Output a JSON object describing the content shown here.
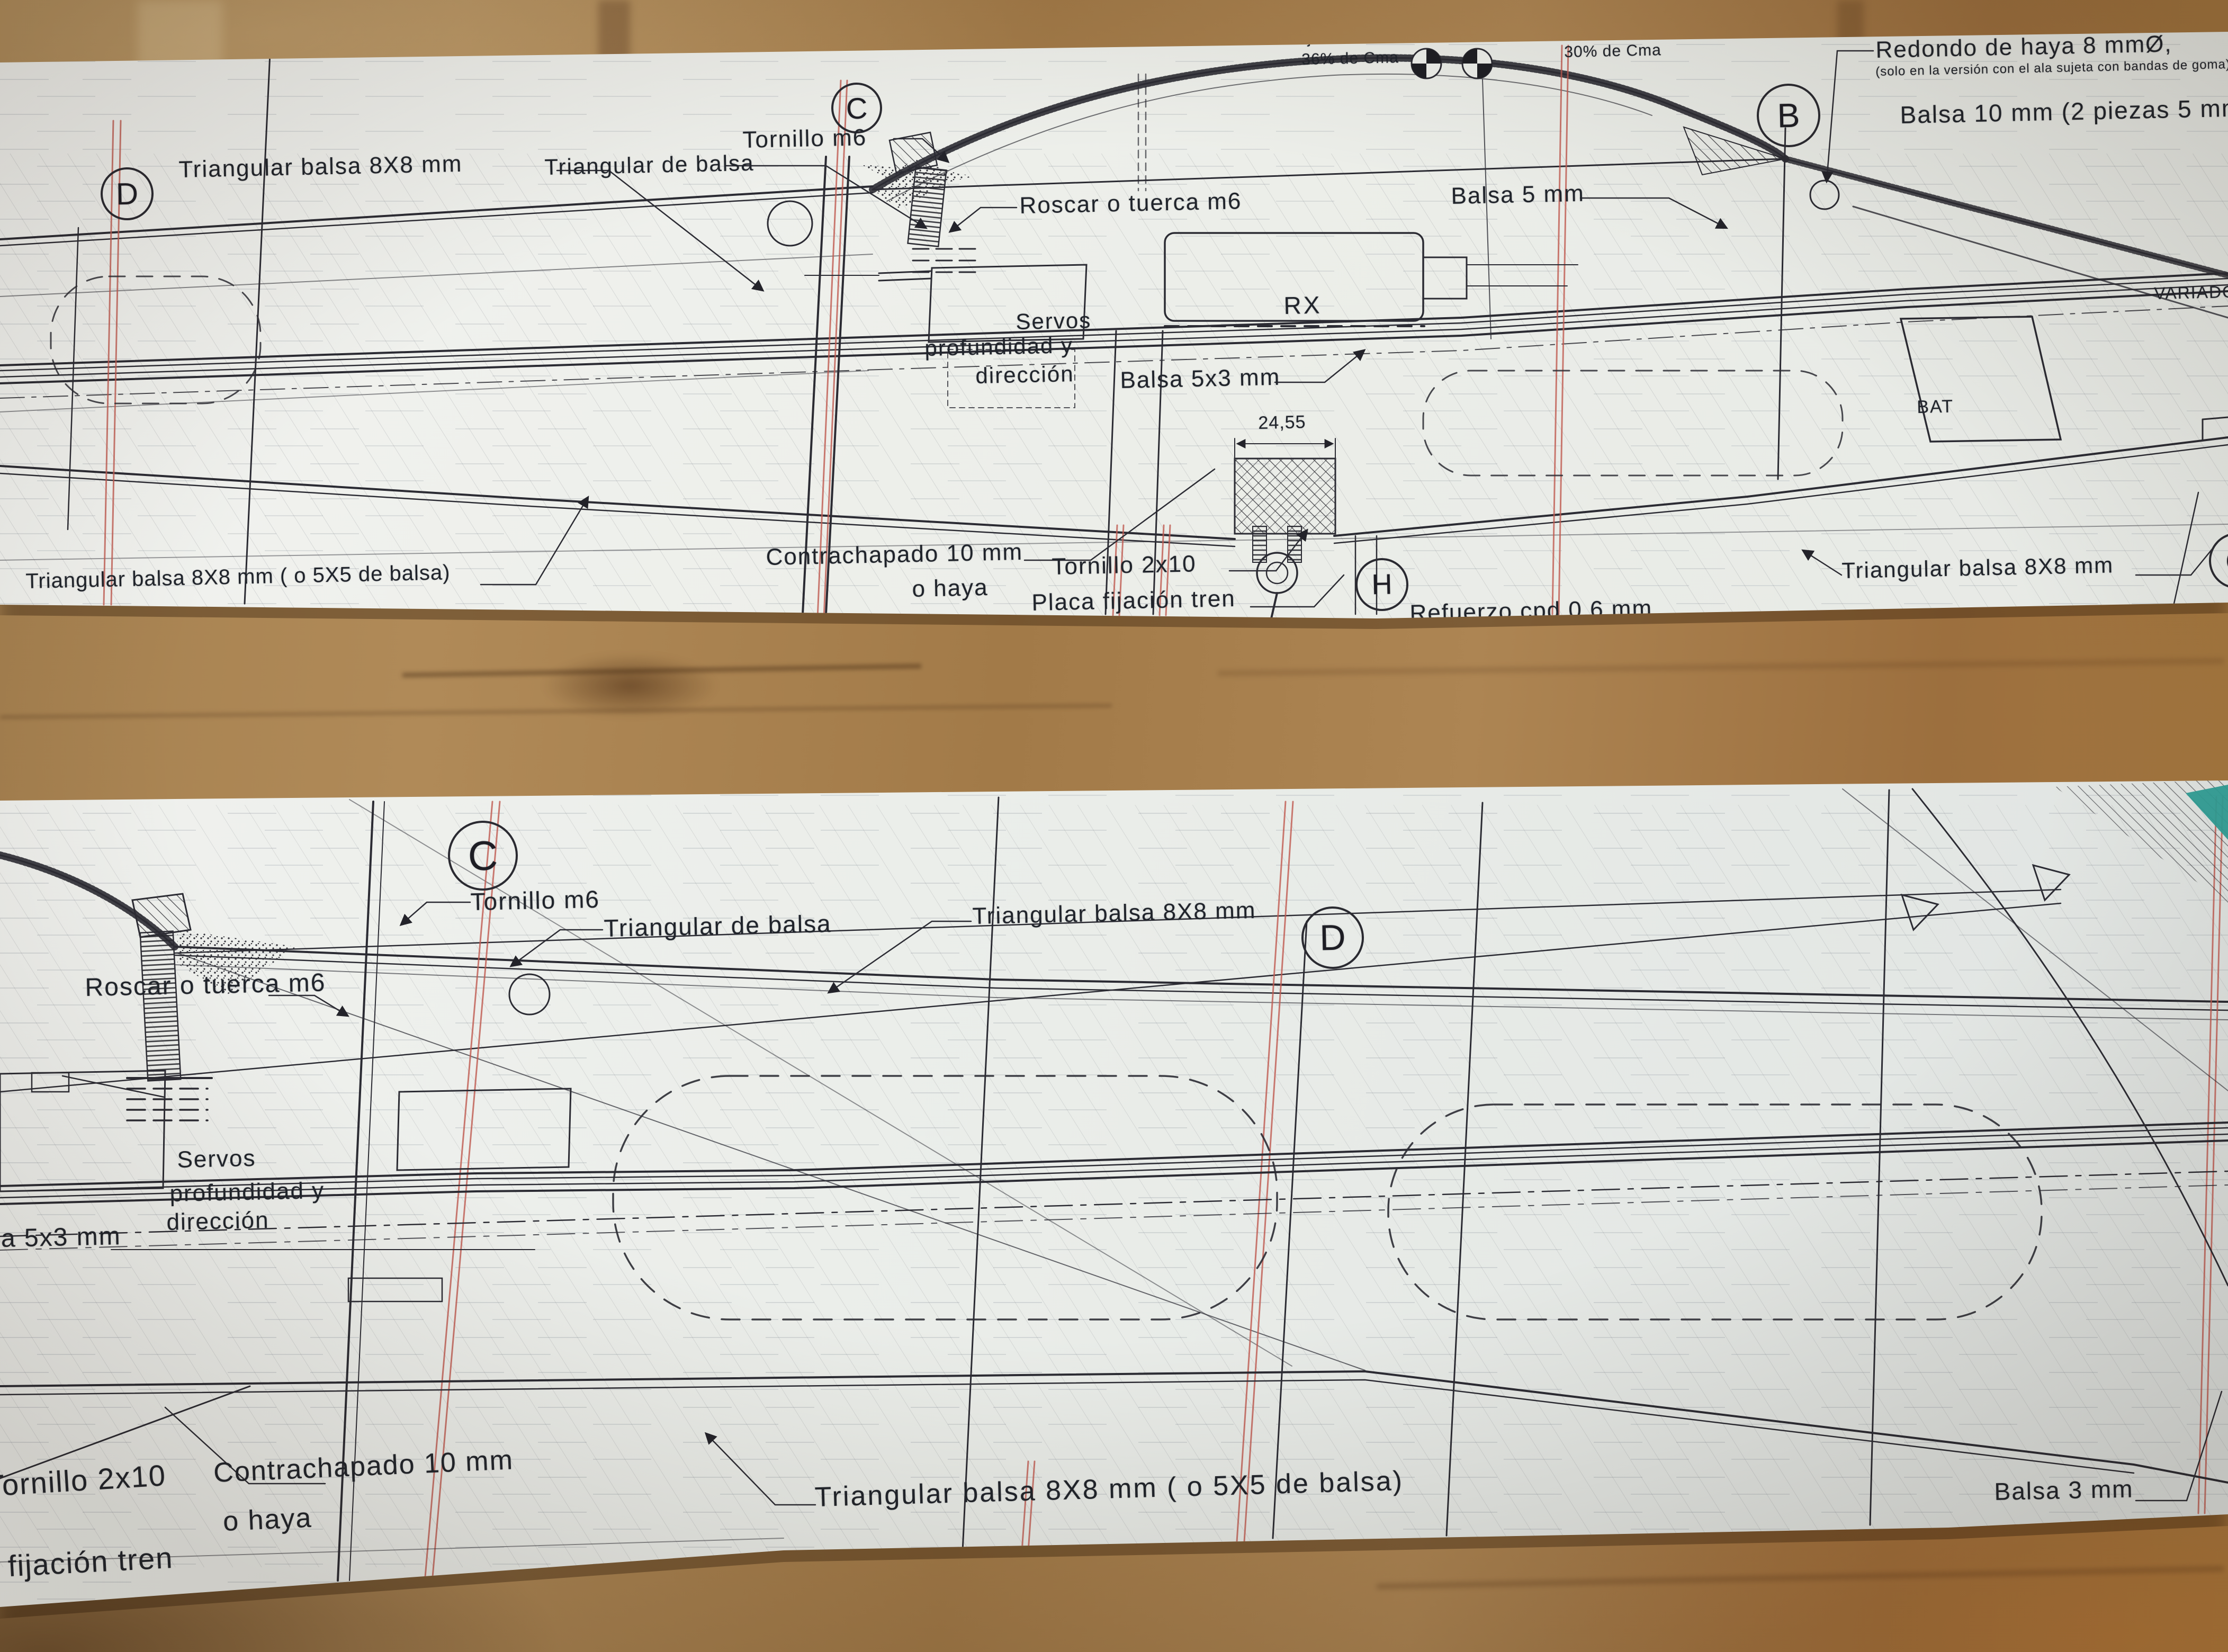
{
  "colors": {
    "wood": "#a9835a",
    "paper": "#eef0ec",
    "ink_line": "#2b2b33",
    "section_line_red": "#c05a50",
    "teal_corner_mark": "#2f9e96"
  },
  "top_sheet": {
    "sections": {
      "d": "D",
      "c": "C",
      "b": "B",
      "h": "H",
      "g": "G"
    },
    "cg_note_left": {
      "line1": "Ajuste del C.G al",
      "line2": "36% de Cma"
    },
    "cg_note_right": {
      "line1": "Ajuste del C.G a",
      "line2": "30% de Cma"
    },
    "labels": {
      "triangular_left": "Triangular balsa 8X8 mm",
      "triangular_de_balsa": "Triangular de balsa",
      "tornillo_m6": "Tornillo m6",
      "roscar_tuerca": "Roscar o tuerca m6",
      "redondo": "Redondo de haya 8 mmØ,",
      "redondo_note": "(solo en la versión con el ala sujeta con bandas de goma)",
      "balsa_10": "Balsa 10 mm (2 piezas 5 mm)",
      "balsa_5": "Balsa 5 mm",
      "rx": "RX",
      "bat": "BAT",
      "variador": "VARIADOR",
      "servos_1": "Servos",
      "servos_2": "profundidad y",
      "servos_3": "dirección",
      "balsa_5x3": "Balsa 5x3 mm",
      "dim_24_55": "24,55",
      "contrachapado_1": "Contrachapado 10 mm",
      "contrachapado_2": "o haya",
      "tornillo_2x10": "Tornillo 2x10",
      "placa": "Placa fijación tren",
      "refuerzo": "Refuerzo cpd 0,6 mm",
      "triangular_bottom": "Triangular balsa 8X8 mm ( o 5X5 de balsa)",
      "triangular_right": "Triangular balsa 8X8 mm"
    }
  },
  "bottom_sheet": {
    "sections": {
      "c": "C",
      "d": "D"
    },
    "labels": {
      "tornillo_m6": "Tornillo m6",
      "triangular_de_balsa": "Triangular de balsa",
      "triangular_8x8": "Triangular balsa 8X8 mm",
      "roscar_tuerca": "Roscar o tuerca m6",
      "servos_1": "Servos",
      "servos_2": "profundidad y",
      "servos_3": "dirección",
      "balsa_5x3": "Balsa 5x3 mm",
      "tornillo_2x10": "Tornillo 2x10",
      "placa": "Placa fijación tren",
      "contrachapado_1": "Contrachapado 10 mm",
      "contrachapado_2": "o haya",
      "triangular_5x5": "Triangular balsa 8X8 mm ( o 5X5 de balsa)",
      "balsa_3": "Balsa 3 mm"
    }
  }
}
